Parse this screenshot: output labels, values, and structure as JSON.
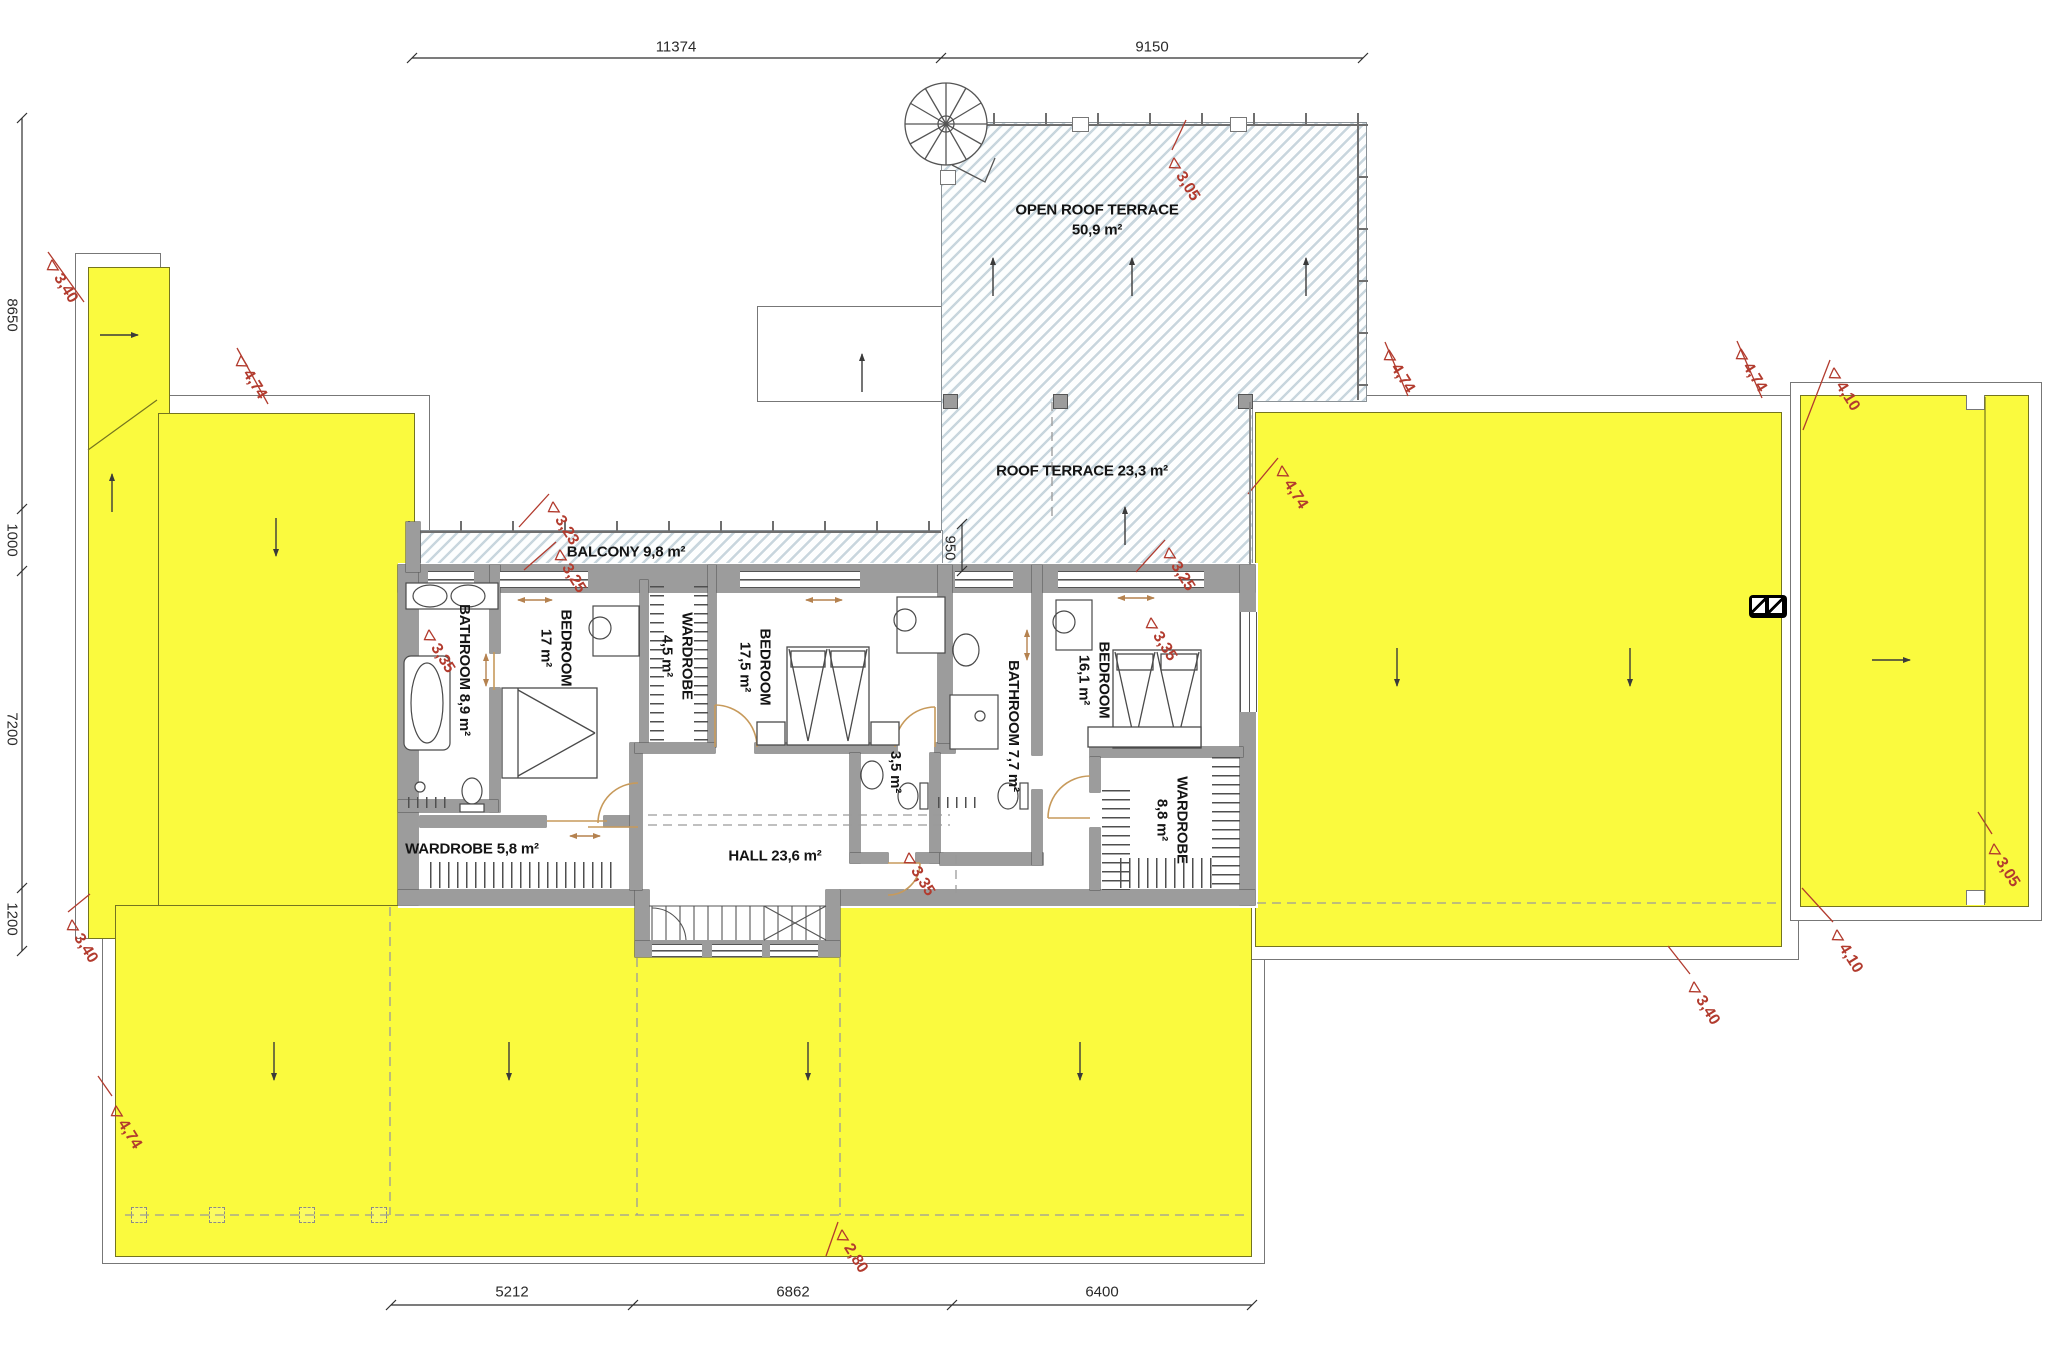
{
  "title": "upper floor roof plan",
  "colors": {
    "roof_yellow": "#fafa3e",
    "hatch_blue": "#94afbd",
    "wall_gray": "#9c9c9c",
    "annotation_red": "#b23b2e",
    "door_tan": "#b5824f",
    "line_dark": "#3a3a3a"
  },
  "rooms": [
    {
      "id": "open-roof-terrace",
      "lines": [
        "OPEN ROOF TERRACE",
        "50,9 m²"
      ]
    },
    {
      "id": "roof-terrace",
      "lines": [
        "ROOF TERRACE  23,3 m²"
      ]
    },
    {
      "id": "balcony",
      "lines": [
        "BALCONY  9,8 m²"
      ]
    },
    {
      "id": "bathroom-1",
      "lines": [
        "BATHROOM 8,9 m²"
      ]
    },
    {
      "id": "bedroom-1",
      "lines": [
        "BEDROOM",
        "17 m²"
      ]
    },
    {
      "id": "wardrobe-1",
      "lines": [
        "WARDROBE",
        "4,5 m²"
      ]
    },
    {
      "id": "bedroom-2",
      "lines": [
        "BEDROOM",
        "17,5 m²"
      ]
    },
    {
      "id": "wc",
      "lines": [
        "3,5 m²"
      ]
    },
    {
      "id": "bathroom-2",
      "lines": [
        "BATHROOM 7,7 m²"
      ]
    },
    {
      "id": "bedroom-3",
      "lines": [
        "BEDROOM",
        "16,1 m²"
      ]
    },
    {
      "id": "wardrobe-2",
      "lines": [
        "WARDROBE",
        "8,8 m²"
      ]
    },
    {
      "id": "wardrobe-3",
      "lines": [
        "WARDROBE 5,8 m²"
      ]
    },
    {
      "id": "hall",
      "lines": [
        "HALL  23,6 m²"
      ]
    }
  ],
  "dims": {
    "top": [
      "11374",
      "9150"
    ],
    "left": [
      "8650",
      "1000",
      "7200",
      "1200"
    ],
    "bottom": [
      "5212",
      "6862",
      "6400"
    ],
    "inner": [
      "950"
    ]
  },
  "levels": [
    "3,40",
    "4,74",
    "3,05",
    "4,74",
    "4,74",
    "4,10",
    "4,74",
    "3,23",
    "3,25",
    "3,25",
    "3,35",
    "3,35",
    "3,35",
    "3,40",
    "3,05",
    "4,10",
    "3,40",
    "4,74",
    "2,80"
  ]
}
